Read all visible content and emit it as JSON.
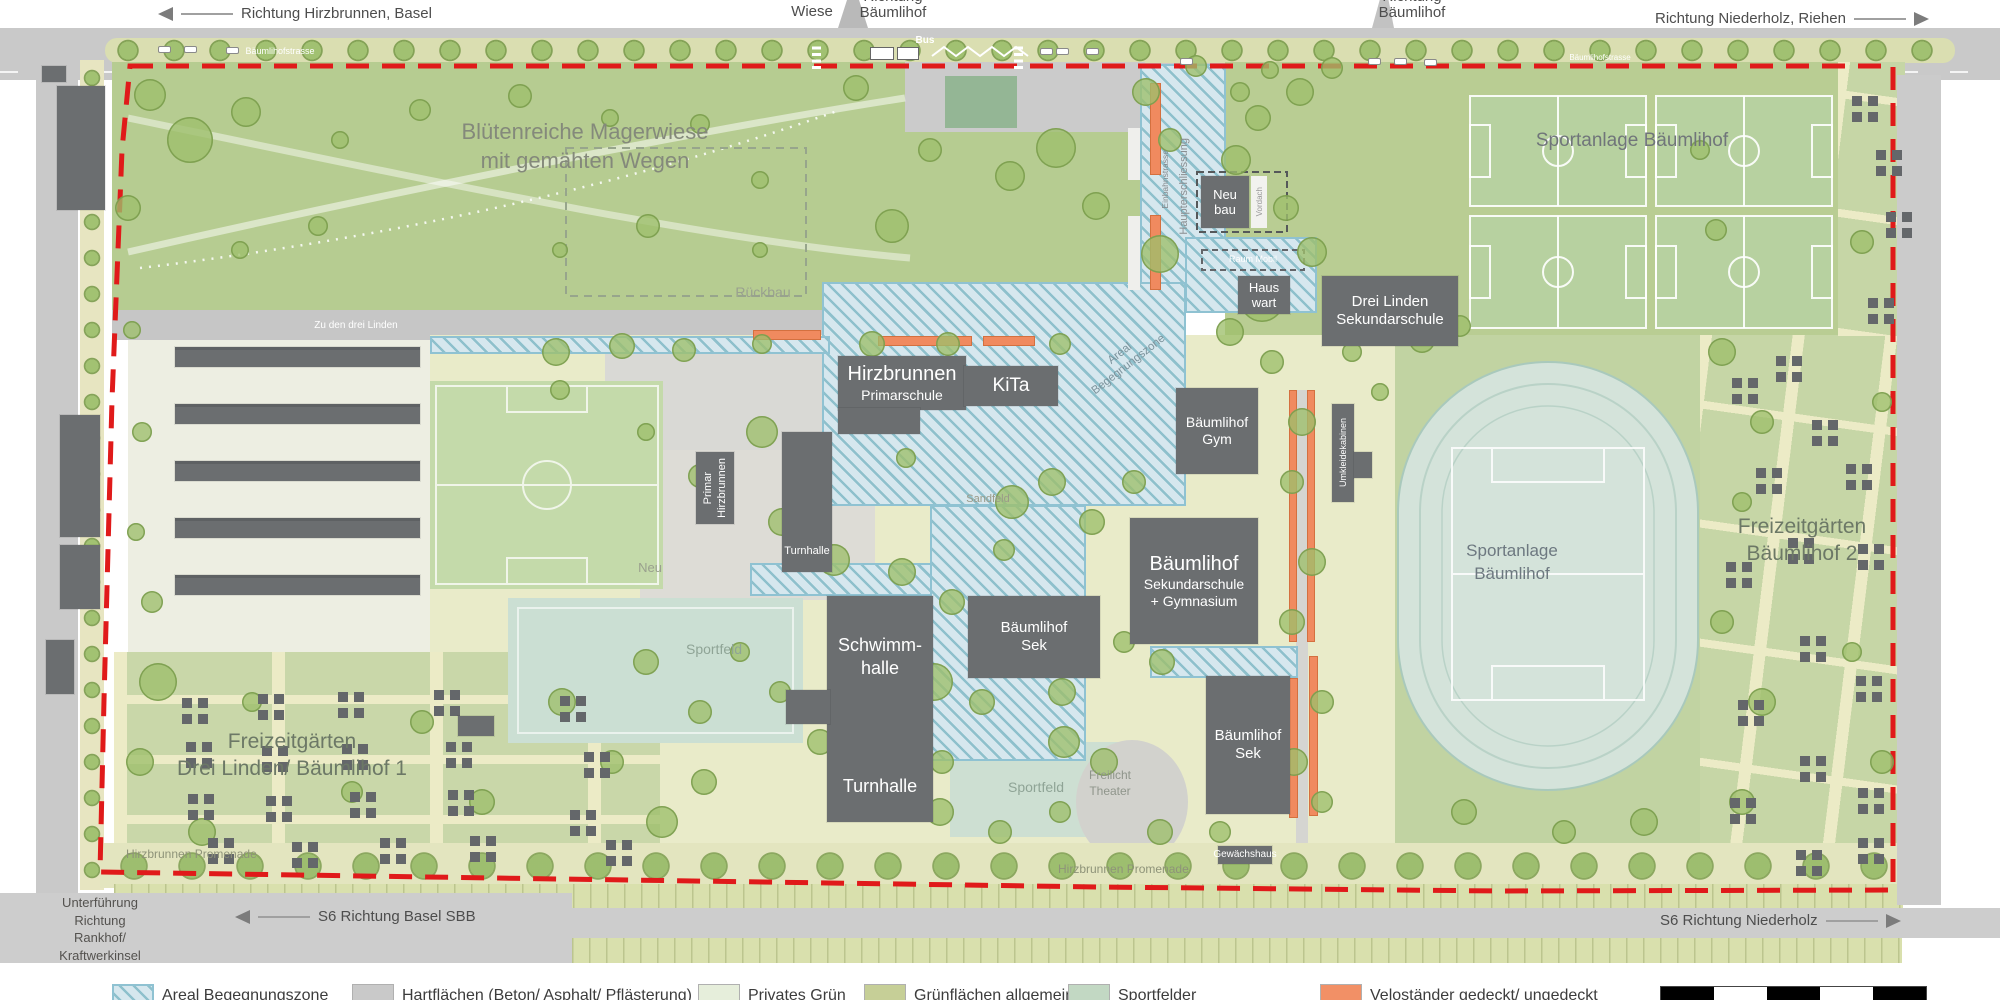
{
  "colors": {
    "boundary_red": "#e01a1a",
    "zone_hatch_bg": "#d6e7ee",
    "zone_hatch_line": "#469aaa",
    "velo_orange": "#f08a5f",
    "building_gray": "#6b6e70",
    "meadow_green": "#b6cc91",
    "campus_ground": "#e9ebc9",
    "sport_teal": "#cfe0d6",
    "road_gray": "#c9c9c9"
  },
  "directions": {
    "top_left": "Richtung Hirzbrunnen, Basel",
    "mid_richtung": "Richtung",
    "mid_wiese": "Wiese",
    "mid_baeumlihof": "Bäumlihof",
    "top_right": "Richtung Niederholz, Riehen",
    "s6_left": "S6 Richtung Basel SBB",
    "s6_right": "S6 Richtung Niederholz",
    "underpass_l1": "Unterführung",
    "underpass_l2": "Richtung",
    "underpass_l3": "Rankhof/",
    "underpass_l4": "Kraftwerkinsel"
  },
  "streets": {
    "baeumlihofstrasse": "Bäumlihofstrasse",
    "baeumlihofstrasse_2": "Bäumlihofstrasse",
    "zu_den_drei_linden": "Zu den drei Linden",
    "promenade_1": "Hirzbrunnen Promenade",
    "promenade_2": "Hirzbrunnen Promenade",
    "bus": "Bus",
    "einbahnstrasse": "Einbahnstrasse",
    "haupterschliessung": "Haupterschliessung"
  },
  "areas": {
    "magerwiese_l1": "Blütenreiche Magerwiese",
    "magerwiese_l2": "mit gemähten Wegen",
    "sportanlage_top": "Sportanlage Bäumlihof",
    "sportanlage_track_l1": "Sportanlage",
    "sportanlage_track_l2": "Bäumlihof",
    "freizeit1_l1": "Freizeitgärten",
    "freizeit1_l2": "Drei Linden/ Bäumlihof 1",
    "freizeit2_l1": "Freizeitgärten",
    "freizeit2_l2": "Bäumlihof 2",
    "zone_l1": "Areal",
    "zone_l2": "Begegnungszone",
    "rueckbau": "Rückbau",
    "sandfeld": "Sandfeld",
    "neu": "Neu",
    "sportfeld_1": "Sportfeld",
    "sportfeld_2": "Sportfeld",
    "freilicht_l1": "Freilicht",
    "freilicht_l2": "Theater",
    "gewaechshaus": "Gewächshaus"
  },
  "buildings": {
    "neubau_l1": "Neu",
    "neubau_l2": "bau",
    "vordach": "Vordach",
    "raum_mobil": "Raum Mobil",
    "hauswart_l1": "Haus",
    "hauswart_l2": "wart",
    "drei_linden_l1": "Drei Linden",
    "drei_linden_l2": "Sekundarschule",
    "hirz_primar_l1": "Hirzbrunnen",
    "hirz_primar_l2": "Primarschule",
    "kita": "KiTa",
    "gym_l1": "Bäumlihof",
    "gym_l2": "Gym",
    "sekgym_l1": "Bäumlihof",
    "sekgym_l2": "Sekundarschule",
    "sekgym_l3": "+ Gymnasium",
    "schwimm_l1": "Schwimm-",
    "schwimm_l2": "halle",
    "turnhalle_big": "Turnhalle",
    "turnhalle_small": "Turnhalle",
    "primar_hirz_l1": "Primar",
    "primar_hirz_l2": "Hirzbrunnen",
    "sek1_l1": "Bäumlihof",
    "sek1_l2": "Sek",
    "sek2_l1": "Bäumlihof",
    "sek2_l2": "Sek",
    "umkleidekabinen": "Umkleidekabinen"
  },
  "legend": {
    "items": [
      {
        "label": "Areal Begegnungszone"
      },
      {
        "label": "Hartflächen (Beton/ Asphalt/ Pflästerung)"
      },
      {
        "label": "Privates Grün"
      },
      {
        "label": "Grünflächen allgemein"
      },
      {
        "label": "Sportfelder"
      },
      {
        "label": "Veloständer gedeckt/ ungedeckt"
      }
    ]
  }
}
